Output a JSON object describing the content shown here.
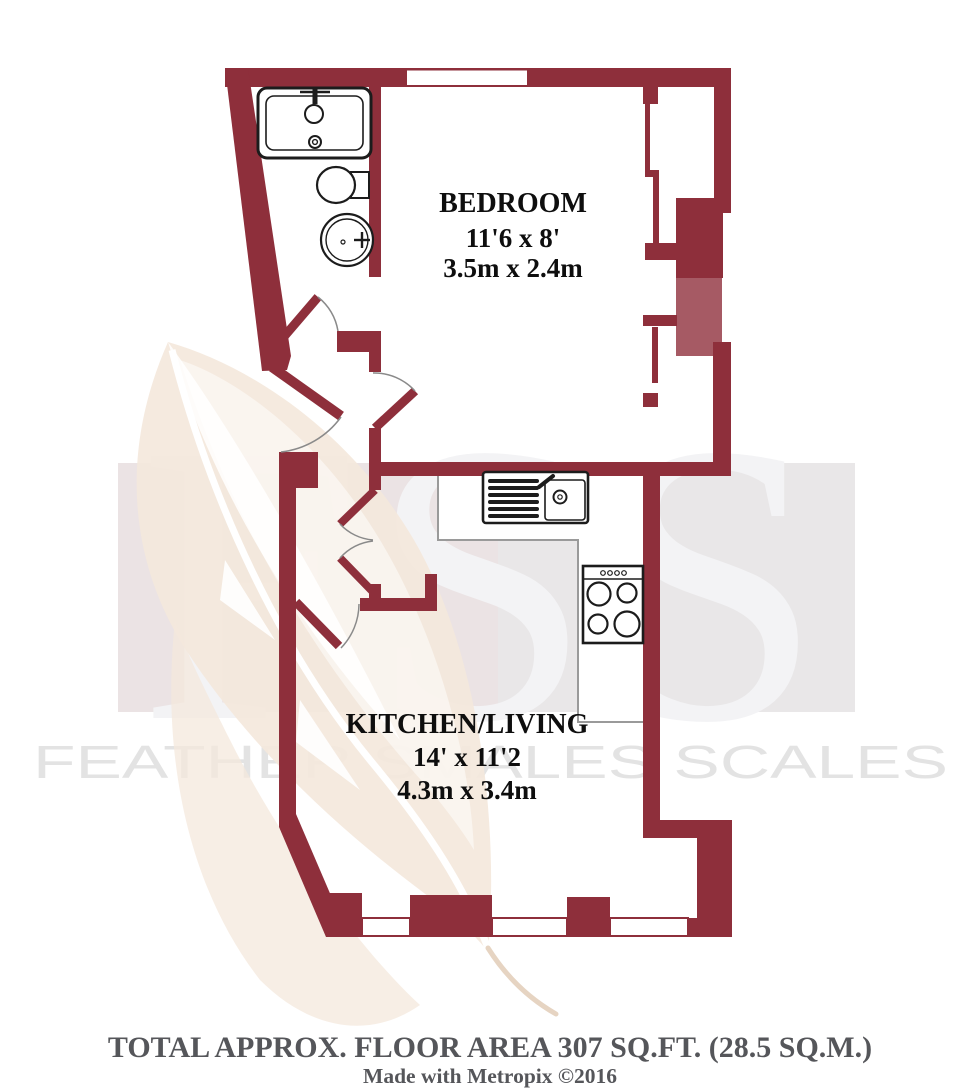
{
  "watermark": {
    "letters": "FSS",
    "company": "FEATHER SMALES SCALES"
  },
  "rooms": [
    {
      "name": "BEDROOM",
      "imperial": "11'6 x 8'",
      "metric": "3.5m x 2.4m"
    },
    {
      "name": "KITCHEN/LIVING",
      "imperial": "14' x 11'2",
      "metric": "4.3m x 3.4m"
    }
  ],
  "fixtures": [
    "bathtub",
    "toilet",
    "basin",
    "kitchen-sink",
    "cooker-hob"
  ],
  "footer": {
    "total_area": "TOTAL APPROX. FLOOR AREA 307 SQ.FT. (28.5 SQ.M.)",
    "credit": "Made with Metropix ©2016"
  },
  "colors": {
    "wall": "#8e2f3b",
    "wall-light": "#a65a64",
    "fixture": "#1c1c1c",
    "arc": "#8a8a8a",
    "counter": "#9a9a9a",
    "label": "#0e0e0e",
    "footer": "#55565a",
    "tile": "#e9e7e8",
    "letters": "#f3f3f5",
    "company": "#e3e3e3",
    "feather": "#f4e8dc",
    "quill": "#e6d4c2"
  }
}
